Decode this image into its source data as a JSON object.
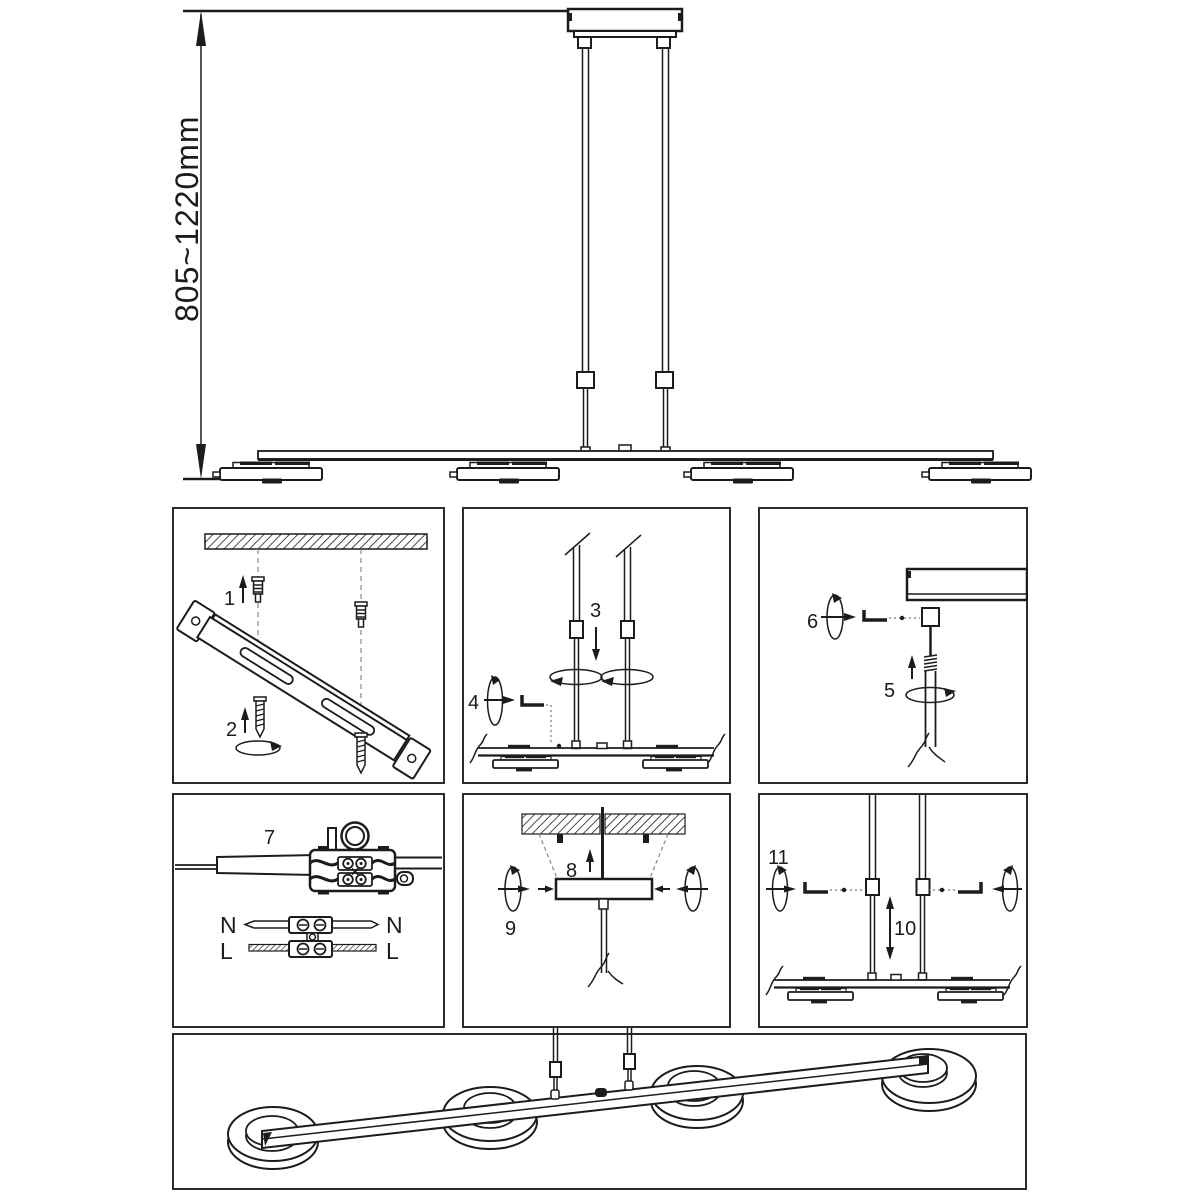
{
  "figure": {
    "dimension_label": "805~1220mm"
  },
  "steps": {
    "s1": "1",
    "s2": "2",
    "s3": "3",
    "s4": "4",
    "s5": "5",
    "s6": "6",
    "s7": "7",
    "s8": "8",
    "s9": "9",
    "s10": "10",
    "s11": "11"
  },
  "wiring": {
    "neutral_left": "N",
    "neutral_right": "N",
    "live_left": "L",
    "live_right": "L"
  },
  "colors": {
    "line": "#1c1c1c",
    "panel_border": "#2b2b2b",
    "dashed_guide": "#8a8a8a",
    "background": "#ffffff"
  }
}
